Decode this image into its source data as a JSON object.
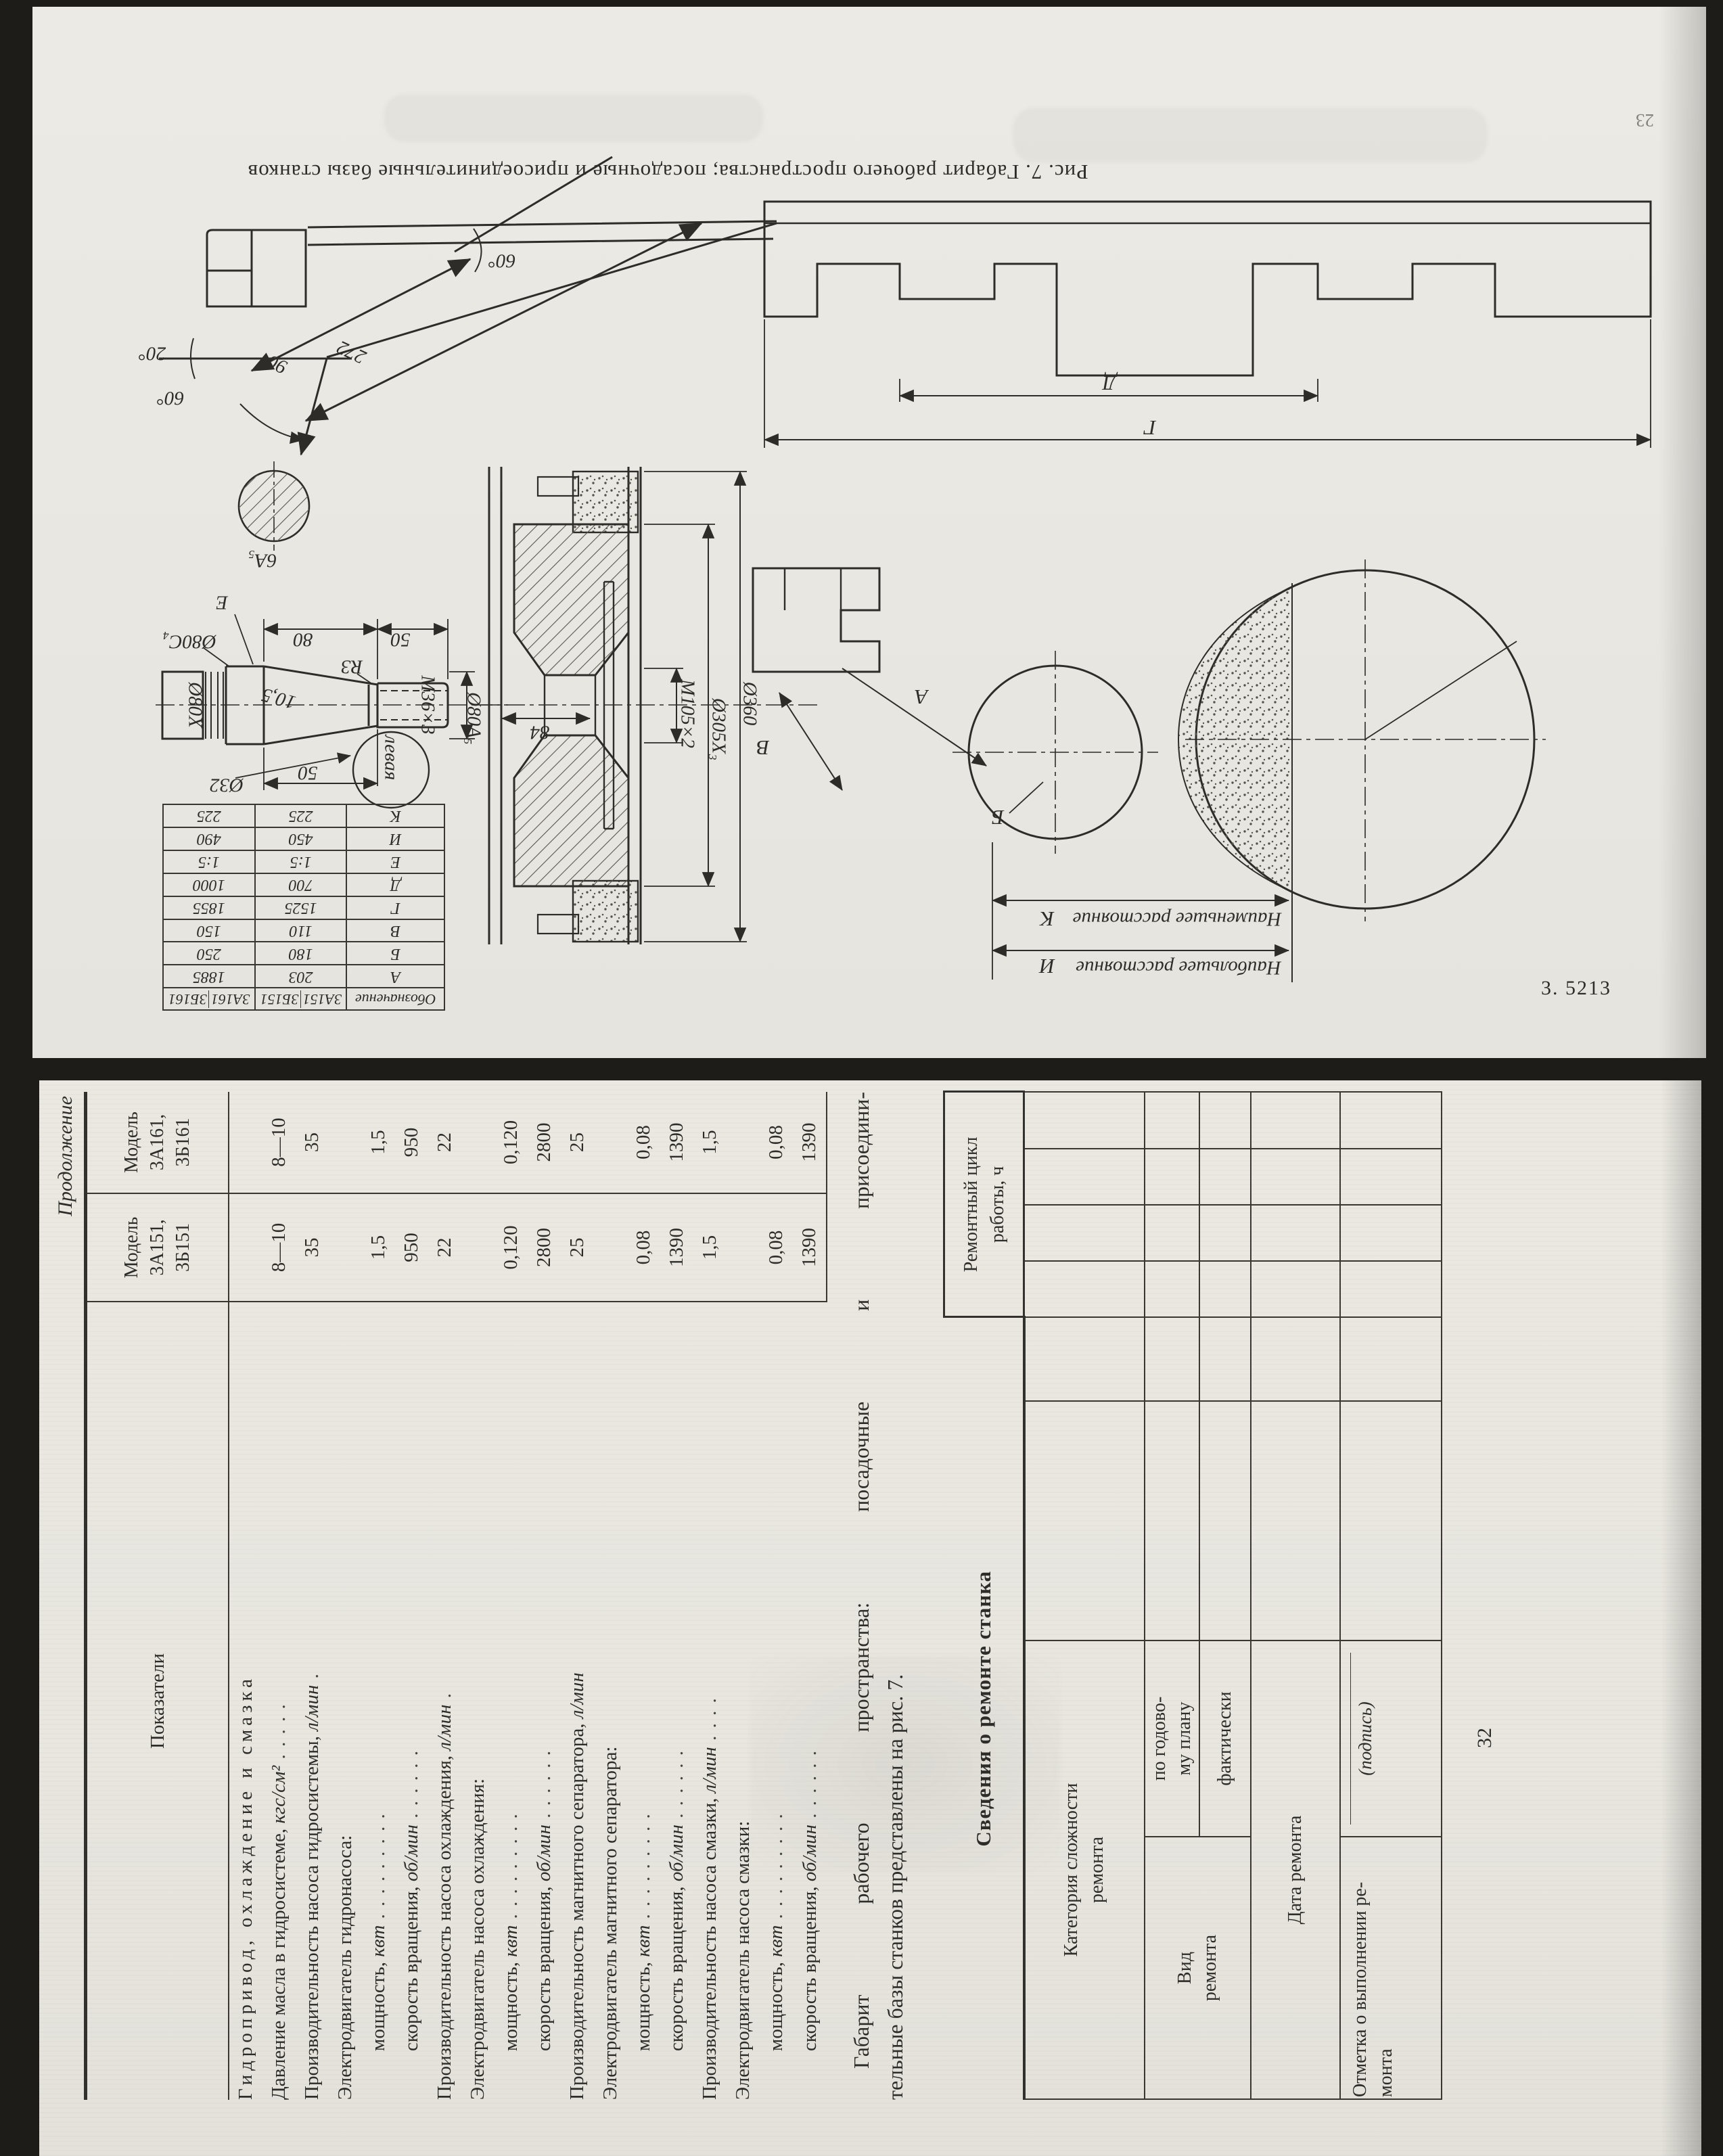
{
  "page_top": {
    "caption": "Рис. 7. Габарит рабочего пространства; посадочные и присоединительные базы станков",
    "print_mark": "3. 5213",
    "page_number": "23",
    "dim_table": {
      "col_designation": "Обозначение",
      "models": [
        "3А151",
        "3Б151",
        "3А161",
        "3Б161"
      ],
      "rows": [
        {
          "k": "А",
          "v1": "203",
          "v2": "1885"
        },
        {
          "k": "Б",
          "v1": "180",
          "v2": "250"
        },
        {
          "k": "В",
          "v1": "110",
          "v2": "150"
        },
        {
          "k": "Г",
          "v1": "1525",
          "v2": "1855"
        },
        {
          "k": "Д",
          "v1": "700",
          "v2": "1000"
        },
        {
          "k": "Е",
          "v1": "1:5",
          "v2": "1:5"
        },
        {
          "k": "И",
          "v1": "450",
          "v2": "490"
        },
        {
          "k": "К",
          "v1": "225",
          "v2": "225"
        }
      ]
    },
    "labels": [
      {
        "text": "20°"
      },
      {
        "text": "60°"
      },
      {
        "text": "90"
      },
      {
        "text": "272"
      },
      {
        "text": "60°"
      },
      {
        "text": "6А₅"
      },
      {
        "text": "Е"
      },
      {
        "text": "80"
      },
      {
        "text": "50"
      },
      {
        "text": "Ø80С₄"
      },
      {
        "text": "Ø80Х"
      },
      {
        "text": "10,5"
      },
      {
        "text": "R3"
      },
      {
        "text": "M36×3"
      },
      {
        "text": "левая"
      },
      {
        "text": "Ø32"
      },
      {
        "text": "50"
      },
      {
        "text": "Ø80А₅"
      },
      {
        "text": "84"
      },
      {
        "text": "M105×2"
      },
      {
        "text": "Ø305Х₃"
      },
      {
        "text": "Ø360"
      },
      {
        "text": "В"
      },
      {
        "text": "А"
      },
      {
        "text": "Б"
      },
      {
        "text": "К"
      },
      {
        "text": "Наименьшее расстояние"
      },
      {
        "text": "И"
      },
      {
        "text": "Наибольшее расстояние"
      },
      {
        "text": "Д"
      },
      {
        "text": "Г"
      }
    ]
  },
  "page_bottom": {
    "continuation_note": "Продолжение",
    "spec_table": {
      "header_col1": "Показатели",
      "header_model1": "Модель\n3А151,\n3Б151",
      "header_model2": "Модель\n3А161,\n3Б161",
      "rows": [
        {
          "t": "Гидропривод, охлаждение и смазка",
          "u": "",
          "d": "",
          "v1": "",
          "v2": ""
        },
        {
          "t": "Давление масла в гидросистеме, ",
          "u": "кгс/см²",
          "d": " .  .  .  .  .",
          "v1": "8—10",
          "v2": "8—10"
        },
        {
          "t": "Производительность насоса гидросистемы, ",
          "u": "л/мин",
          "d": " .",
          "v1": "35",
          "v2": "35"
        },
        {
          "t": "Электродвигатель гидронасоса:",
          "u": "",
          "d": "",
          "v1": "",
          "v2": ""
        },
        {
          "t": "мощность, ",
          "u": "квт",
          "d": " .  .  .  .  .  .  .  .  .",
          "v1": "1,5",
          "v2": "1,5"
        },
        {
          "t": "скорость вращения, ",
          "u": "об/мин",
          "d": " .  .  .  .  .  .",
          "v1": "950",
          "v2": "950"
        },
        {
          "t": "Производительность насоса охлаждения, ",
          "u": "л/мин",
          "d": " .",
          "v1": "22",
          "v2": "22"
        },
        {
          "t": "Электродвигатель насоса охлаждения:",
          "u": "",
          "d": "",
          "v1": "",
          "v2": ""
        },
        {
          "t": "мощность, ",
          "u": "квт",
          "d": " .  .  .  .  .  .  .  .  .",
          "v1": "0,120",
          "v2": "0,120"
        },
        {
          "t": "скорость вращения, ",
          "u": "об/мин",
          "d": " .  .  .  .  .  .",
          "v1": "2800",
          "v2": "2800"
        },
        {
          "t": "Производительность магнитного сепаратора, ",
          "u": "л/мин",
          "d": "",
          "v1": "25",
          "v2": "25"
        },
        {
          "t": "Электродвигатель магнитного сепаратора:",
          "u": "",
          "d": "",
          "v1": "",
          "v2": ""
        },
        {
          "t": "мощность, ",
          "u": "квт",
          "d": " .  .  .  .  .  .  .  .  .",
          "v1": "0,08",
          "v2": "0,08"
        },
        {
          "t": "скорость вращения, ",
          "u": "об/мин",
          "d": " .  .  .  .  .  .",
          "v1": "1390",
          "v2": "1390"
        },
        {
          "t": "Производительность насоса смазки, ",
          "u": "л/мин",
          "d": " .  .  .  .",
          "v1": "1,5",
          "v2": "1,5"
        },
        {
          "t": "Электродвигатель насоса смазки:",
          "u": "",
          "d": "",
          "v1": "",
          "v2": ""
        },
        {
          "t": "мощность, ",
          "u": "квт",
          "d": " .  .  .  .  .  .  .  .  .",
          "v1": "0,08",
          "v2": "0,08"
        },
        {
          "t": "скорость вращения, ",
          "u": "об/мин",
          "d": " .  .  .  .  .  .",
          "v1": "1390",
          "v2": "1390"
        }
      ]
    },
    "paragraph_line1": "Габарит рабочего пространства: посадочные и присоедини-",
    "paragraph_line2": "тельные базы станков представлены на рис. 7.",
    "section_heading": "Сведения о ремонте станка",
    "repair_table": {
      "cycle_header": "Ремонтный цикл\nработы, ч",
      "complexity": "Категория сложности\nремонта",
      "kind": "Вид\nремонта",
      "by_plan": "по годово-\nму плану",
      "actual": "фактически",
      "date": "Дата ремонта",
      "mark": "Отметка  о  выполнении  ре-\nмонта",
      "signature": "(подпись)"
    },
    "page_number": "32"
  }
}
